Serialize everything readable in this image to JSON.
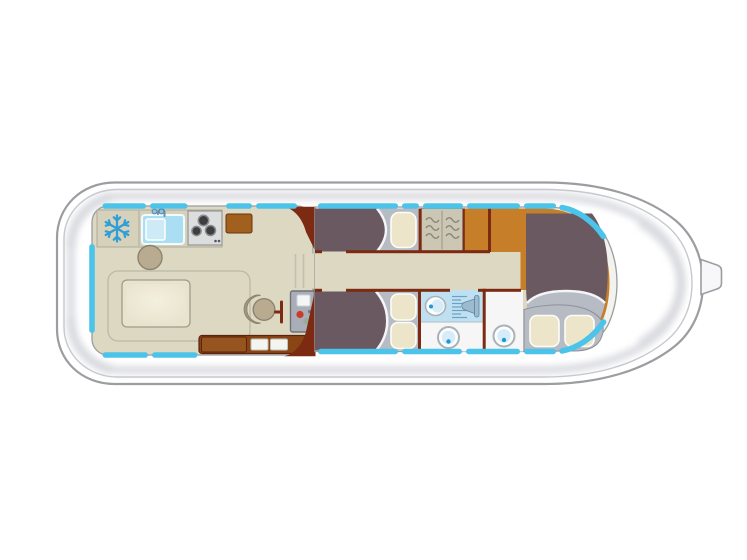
{
  "diagram": {
    "kind": "canal-boat-floor-plan",
    "orientation": "bow-right",
    "areas": [
      {
        "id": "aft-deck"
      },
      {
        "id": "saloon-galley"
      },
      {
        "id": "companionway"
      },
      {
        "id": "corridor"
      },
      {
        "id": "port-cabin",
        "pillows": 1
      },
      {
        "id": "starboard-cabin",
        "pillows": 2
      },
      {
        "id": "wardrobe",
        "hangers": 6
      },
      {
        "id": "shower-room"
      },
      {
        "id": "wc-room-aft"
      },
      {
        "id": "wc-room-forward"
      },
      {
        "id": "bow-cabin",
        "pillows": 2
      },
      {
        "id": "foredeck"
      }
    ],
    "fixtures": [
      {
        "id": "fridge",
        "icon": "snowflake-icon",
        "area": "saloon-galley"
      },
      {
        "id": "sink",
        "icon": "sink-icon",
        "area": "saloon-galley"
      },
      {
        "id": "faucet",
        "icon": "faucet-icon",
        "area": "saloon-galley"
      },
      {
        "id": "stove",
        "icon": "stove-icon",
        "burners": 3,
        "area": "saloon-galley"
      },
      {
        "id": "stool",
        "icon": "round-stool-icon",
        "area": "saloon-galley"
      },
      {
        "id": "dining-table",
        "icon": "table-icon",
        "area": "saloon-galley"
      },
      {
        "id": "bench-seating",
        "area": "saloon-galley"
      },
      {
        "id": "helm-seat",
        "icon": "swivel-seat-icon",
        "area": "saloon-galley"
      },
      {
        "id": "steering-console",
        "icon": "console-icon",
        "area": "saloon-galley"
      },
      {
        "id": "throttle-lever",
        "icon": "lever-icon",
        "area": "saloon-galley"
      },
      {
        "id": "sideboard",
        "area": "saloon-galley"
      },
      {
        "id": "entry-steps",
        "doors": 2,
        "area": "saloon-galley"
      },
      {
        "id": "companionway-steps",
        "steps": 3,
        "area": "companionway"
      },
      {
        "id": "bed-port-cabin",
        "icon": "berth-icon",
        "area": "port-cabin"
      },
      {
        "id": "bed-starboard-cabin",
        "icon": "berth-icon",
        "area": "starboard-cabin"
      },
      {
        "id": "wardrobe-hangers",
        "icon": "hanger-icon",
        "area": "wardrobe"
      },
      {
        "id": "shower",
        "icon": "shower-icon",
        "area": "shower-room"
      },
      {
        "id": "washbasin-shower-room",
        "icon": "washbasin-icon",
        "area": "shower-room"
      },
      {
        "id": "washbasin-wc-aft",
        "icon": "washbasin-icon",
        "area": "wc-room-aft"
      },
      {
        "id": "washbasin-wc-forward",
        "icon": "washbasin-icon",
        "area": "wc-room-forward"
      },
      {
        "id": "bed-bow-cabin",
        "icon": "berth-icon",
        "area": "bow-cabin"
      },
      {
        "id": "bow-cleat",
        "icon": "cleat-icon",
        "area": "foredeck"
      },
      {
        "id": "windows",
        "icon": "window-strip",
        "color_key": "window"
      }
    ]
  },
  "colors": {
    "hull_line": "#9c9da1",
    "hull_fill": "#ffffff",
    "gunwale": "#c7c8cd",
    "deck_shade": "#d8d9df",
    "cabin_line": "#9b9c9e",
    "cabin_band": "#f2f2ee",
    "floor": "#ddd8c2",
    "counter": "#d6d1bb",
    "counter_line": "#aeab9b",
    "window": "#4cc4ea",
    "wall": "#7c2a12",
    "wood_dark": "#8a4515",
    "wood_box": "#96551e",
    "wood_line": "#5e230c",
    "cabinet_wood": "#a2601e",
    "orange_floor": "#c67f28",
    "bed": "#6a5960",
    "blanket": "#b7bbc4",
    "blanket_line": "#8d9099",
    "white_arc": "#f4f5f7",
    "pillow": "#ece5c9",
    "pillow_line": "#fdfdf8",
    "wardrobe": "#ccc7b2",
    "hanger": "#82827c",
    "shower_bg": "#bee0f1",
    "shower_line": "#6f9fc2",
    "fixture_metal": "#9dbbcf",
    "room_white": "#f5f6f5",
    "basin_ring": "#aab1b7",
    "basin_fill": "#fcfdfd",
    "basin_inner": "#d6ecf8",
    "water_dot": "#1f98d4",
    "seat": "#b9ab90",
    "seat_back": "#a79a7e",
    "seat_line": "#8c8470",
    "console": "#a9aeb8",
    "console_line": "#6e7278",
    "screen": "#f4f5f7",
    "red_button": "#cd3a28",
    "green_button": "#9aaa9c",
    "stove_panel": "#dcdddd",
    "burner": "#3d3d42",
    "burner_ring": "#8b8b90",
    "sink": "#aadef2",
    "sink_inner": "#cdeaf7",
    "faucet": "#6b8fa8",
    "fridge": "#2d9ed8",
    "table": "#e8e3cd",
    "table_line": "#a09c8a",
    "bench_line": "#bcb8a8",
    "step_line": "#c3bfae"
  }
}
